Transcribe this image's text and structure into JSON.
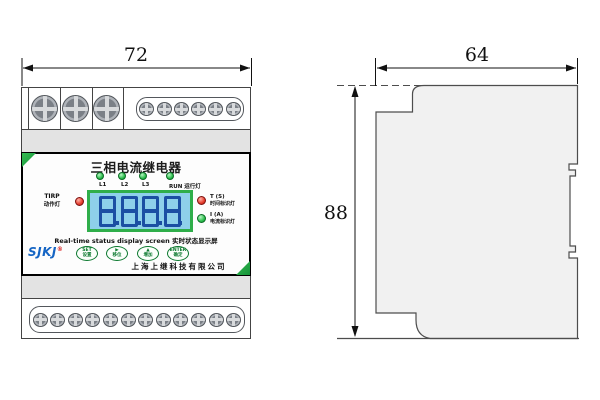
{
  "drawing": {
    "dims": {
      "front_width": "72",
      "side_width": "64",
      "side_height": "88"
    }
  },
  "device": {
    "title": "三相电流继电器",
    "phase_leds": [
      {
        "label": "L1"
      },
      {
        "label": "L2"
      },
      {
        "label": "L3"
      }
    ],
    "run_led_label": "RUN 运行灯",
    "trip_led": {
      "en": "TIRP",
      "zh": "动作灯"
    },
    "display": {
      "value": "8888",
      "caption_en": "Real-time status display screen",
      "caption_zh": "实时状态显示屏"
    },
    "time_led": {
      "en": "T (S)",
      "zh": "时间标识灯"
    },
    "current_led": {
      "en": "I (A)",
      "zh": "电流标识灯"
    },
    "logo": {
      "text": "SJKJ",
      "reg": "®"
    },
    "buttons": [
      {
        "top": "SET",
        "bottom": "设置"
      },
      {
        "top": "▶",
        "bottom": "移位"
      },
      {
        "top": "▲",
        "bottom": "增加"
      },
      {
        "top": "ENTER",
        "bottom": "确定"
      }
    ],
    "company": "上海上继科技有限公司"
  },
  "colors": {
    "accent_green": "#2fae4a",
    "lcd_background": "#8ed0ea",
    "digit_blue": "#1b4fa3",
    "logo_blue": "#1565c4",
    "led_red": "#e63c2c"
  }
}
